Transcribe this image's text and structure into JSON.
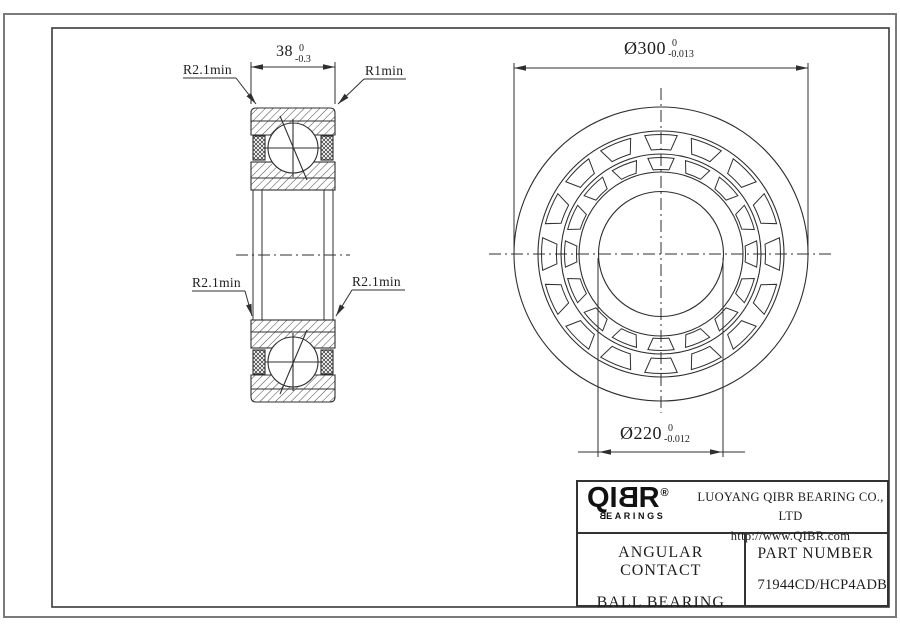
{
  "drawing": {
    "width_dim": {
      "main": "38",
      "tol_upper": "0",
      "tol_lower": "-0.3"
    },
    "od_dim": {
      "main": "Ø300",
      "tol_upper": "0",
      "tol_lower": "-0.013"
    },
    "bore_dim": {
      "main": "Ø220",
      "tol_upper": "0",
      "tol_lower": "-0.012"
    },
    "radius_labels": {
      "top_left": "R2.1min",
      "top_right": "R1min",
      "mid_left": "R2.1min",
      "mid_right": "R2.1min"
    }
  },
  "title_block": {
    "logo": {
      "main_prefix": "QI",
      "main_mirrored_b": "B",
      "main_suffix": "R",
      "registered": "®",
      "sub_mirrored_b": "B",
      "sub_rest": "EARINGS"
    },
    "company_name": "LUOYANG QIBR BEARING CO., LTD",
    "website": "http://www.QIBR.com",
    "product_name_line1": "ANGULAR CONTACT",
    "product_name_line2": "BALL BEARING",
    "part_number_label": "PART NUMBER",
    "part_number": "71944CD/HCP4ADB"
  },
  "colors": {
    "line_color": "#2f2f2f",
    "frame_outer": "#7a7a7a",
    "frame_inner": "#3a3a3a",
    "logo_color": "#111111",
    "background": "#ffffff"
  }
}
